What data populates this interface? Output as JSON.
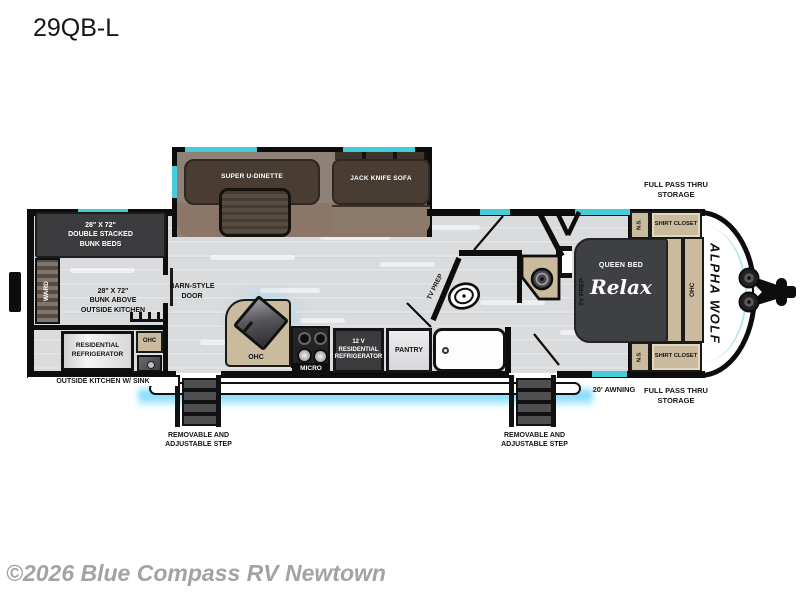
{
  "title": "29QB-L",
  "watermark": "©2026 Blue Compass RV Newtown",
  "brand": "ALPHA WOLF",
  "colors": {
    "wall": "#0d0d0d",
    "floor": "#d9dbdd",
    "counter_tan": "#cabb9f",
    "dark_furniture": "#3c3c3f",
    "slide_brown": "#493d33",
    "window_teal": "#46ccd9",
    "awning_glow": "#50cdff",
    "watermark_gray": "#a3a3a3"
  },
  "labels": {
    "dinette": "SUPER U-DINETTE",
    "sofa": "JACK KNIFE SOFA",
    "bunk_beds": {
      "l1": "28\" X 72\"",
      "l2": "DOUBLE STACKED",
      "l3": "BUNK BEDS"
    },
    "ward": "WARD",
    "bunk_above": {
      "l1": "28\" X 72\"",
      "l2": "BUNK ABOVE",
      "l3": "OUTSIDE KITCHEN"
    },
    "res_fridge": {
      "l1": "RESIDENTIAL",
      "l2": "REFRIGERATOR"
    },
    "ohc": "OHC",
    "outside_kitchen": "OUTSIDE KITCHEN W/ SINK",
    "barn_door": {
      "l1": "BARN-STYLE",
      "l2": "DOOR"
    },
    "micro": "MICRO",
    "fridge_12v": {
      "l1": "12 V",
      "l2": "RESIDENTIAL",
      "l3": "REFRIGERATOR"
    },
    "pantry": "PANTRY",
    "tv_prep": "TV PREP",
    "queen_bed": "QUEEN BED",
    "relax": "Relax",
    "ns": "N.S.",
    "shirt_closet": "SHIRT CLOSET",
    "storage": {
      "l1": "FULL PASS THRU",
      "l2": "STORAGE"
    },
    "awning": "20' AWNING",
    "step": {
      "l1": "REMOVABLE AND",
      "l2": "ADJUSTABLE STEP"
    }
  }
}
